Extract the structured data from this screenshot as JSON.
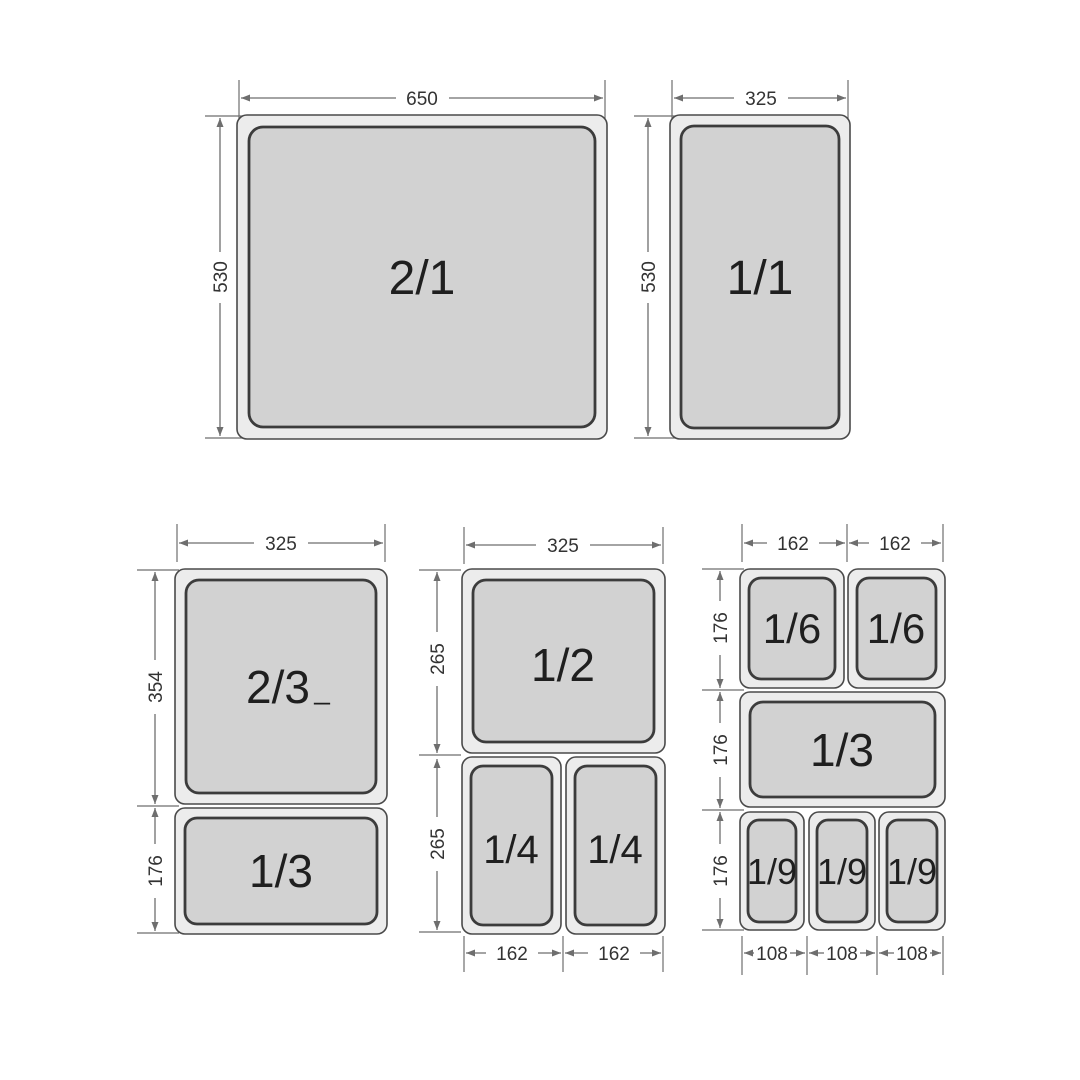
{
  "colors": {
    "background": "#ffffff",
    "pan_fill": "#d2d2d2",
    "pan_outer_fill": "#ececec",
    "pan_stroke": "#4a4a4a",
    "pan_inner_stroke": "#3c3c3c",
    "dim_color": "#6e6e6e",
    "dim_text_color": "#333333",
    "label_color": "#1f1f1f"
  },
  "groups": {
    "g21": {
      "label": "2/1",
      "width": "650",
      "height": "530"
    },
    "g11": {
      "label": "1/1",
      "width": "325",
      "height": "530"
    },
    "g23": {
      "top_label": "2/3",
      "top_label_mark": "_",
      "bottom_label": "1/3",
      "width": "325",
      "top_height": "354",
      "bottom_height": "176"
    },
    "g12": {
      "top_label": "1/2",
      "left_label": "1/4",
      "right_label": "1/4",
      "width": "325",
      "top_height": "265",
      "bottom_height": "265",
      "bottom_left_width": "162",
      "bottom_right_width": "162"
    },
    "g6": {
      "sixth_left_label": "1/6",
      "sixth_right_label": "1/6",
      "third_label": "1/3",
      "ninth_labels": [
        "1/9",
        "1/9",
        "1/9"
      ],
      "top_widths": [
        "162",
        "162"
      ],
      "row_heights": [
        "176",
        "176",
        "176"
      ],
      "bottom_widths": [
        "108",
        "108",
        "108"
      ]
    }
  }
}
